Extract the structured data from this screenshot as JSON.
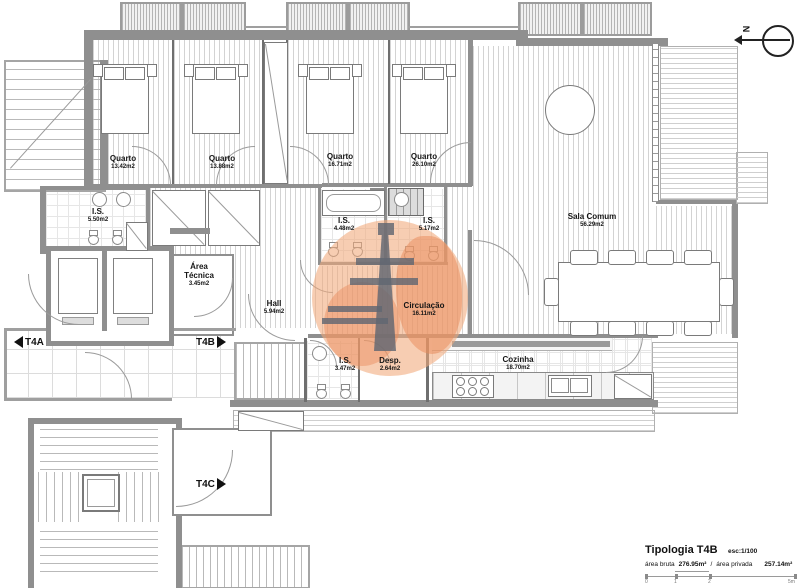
{
  "plan": {
    "rooms": [
      {
        "name": "Quarto",
        "area": "13.42m2"
      },
      {
        "name": "Quarto",
        "area": "13.88m2"
      },
      {
        "name": "Quarto",
        "area": "16.71m2"
      },
      {
        "name": "Quarto",
        "area": "26.10m2"
      },
      {
        "name": "I.S.",
        "area": "5.50m2"
      },
      {
        "name": "I.S.",
        "area": "4.48m2"
      },
      {
        "name": "I.S.",
        "area": "5.17m2"
      },
      {
        "name": "Sala Comum",
        "area": "56.29m2"
      },
      {
        "name": "Área Técnica",
        "area": "3.45m2"
      },
      {
        "name": "Hall",
        "area": "5.94m2"
      },
      {
        "name": "Circulação",
        "area": "16.11m2"
      },
      {
        "name": "I.S.",
        "area": "3.47m2"
      },
      {
        "name": "Desp.",
        "area": "2.64m2"
      },
      {
        "name": "Cozinha",
        "area": "18.70m2"
      }
    ],
    "markers": {
      "t4a": "T4A",
      "t4b": "T4B",
      "t4c": "T4C"
    },
    "north_label": "N"
  },
  "title_block": {
    "title": "Tipologia T4B",
    "scale": "esc:1/100",
    "area_bruta_label": "área bruta",
    "area_bruta_value": "276.95m²",
    "separator": "/",
    "area_privada_label": "área privada",
    "area_privada_value": "257.14m²",
    "scale_ticks": [
      "0",
      "1",
      "2",
      "5m"
    ]
  },
  "colors": {
    "wall": "#8f8f8f",
    "watermark": "#f0a878",
    "line": "#777777"
  }
}
